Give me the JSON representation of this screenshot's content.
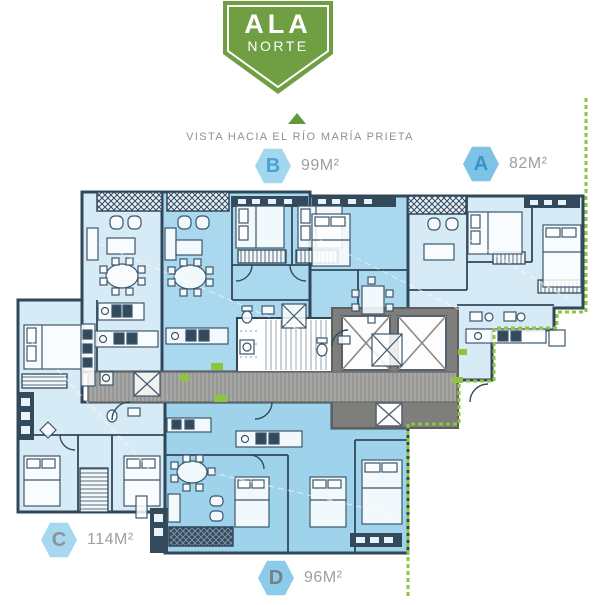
{
  "badge": {
    "line1": "ALA",
    "line2": "NORTE"
  },
  "orientation": {
    "label": "VISTA HACIA EL RÍO MARÍA PRIETA"
  },
  "units": [
    {
      "id": "B",
      "area": "99M²"
    },
    {
      "id": "A",
      "area": "82M²"
    },
    {
      "id": "C",
      "area": "114M²"
    },
    {
      "id": "D",
      "area": "96M²"
    }
  ],
  "colors": {
    "badge_green": "#6f9e43",
    "arrow_green": "#5e9a3e",
    "boundary_dash_green": "#8cc63e",
    "unit_fill_light": "#d7ebf6",
    "unit_fill_medium": "#a9d8ef",
    "wall_navy": "#31475a",
    "corridor_gray": "#a7a7a5",
    "core_gray": "#7e7e7c",
    "hex_blue_light": "#a3d7ef",
    "hex_blue_dark": "#7cc3e6",
    "label_text_gray": "#9aa0a3"
  }
}
